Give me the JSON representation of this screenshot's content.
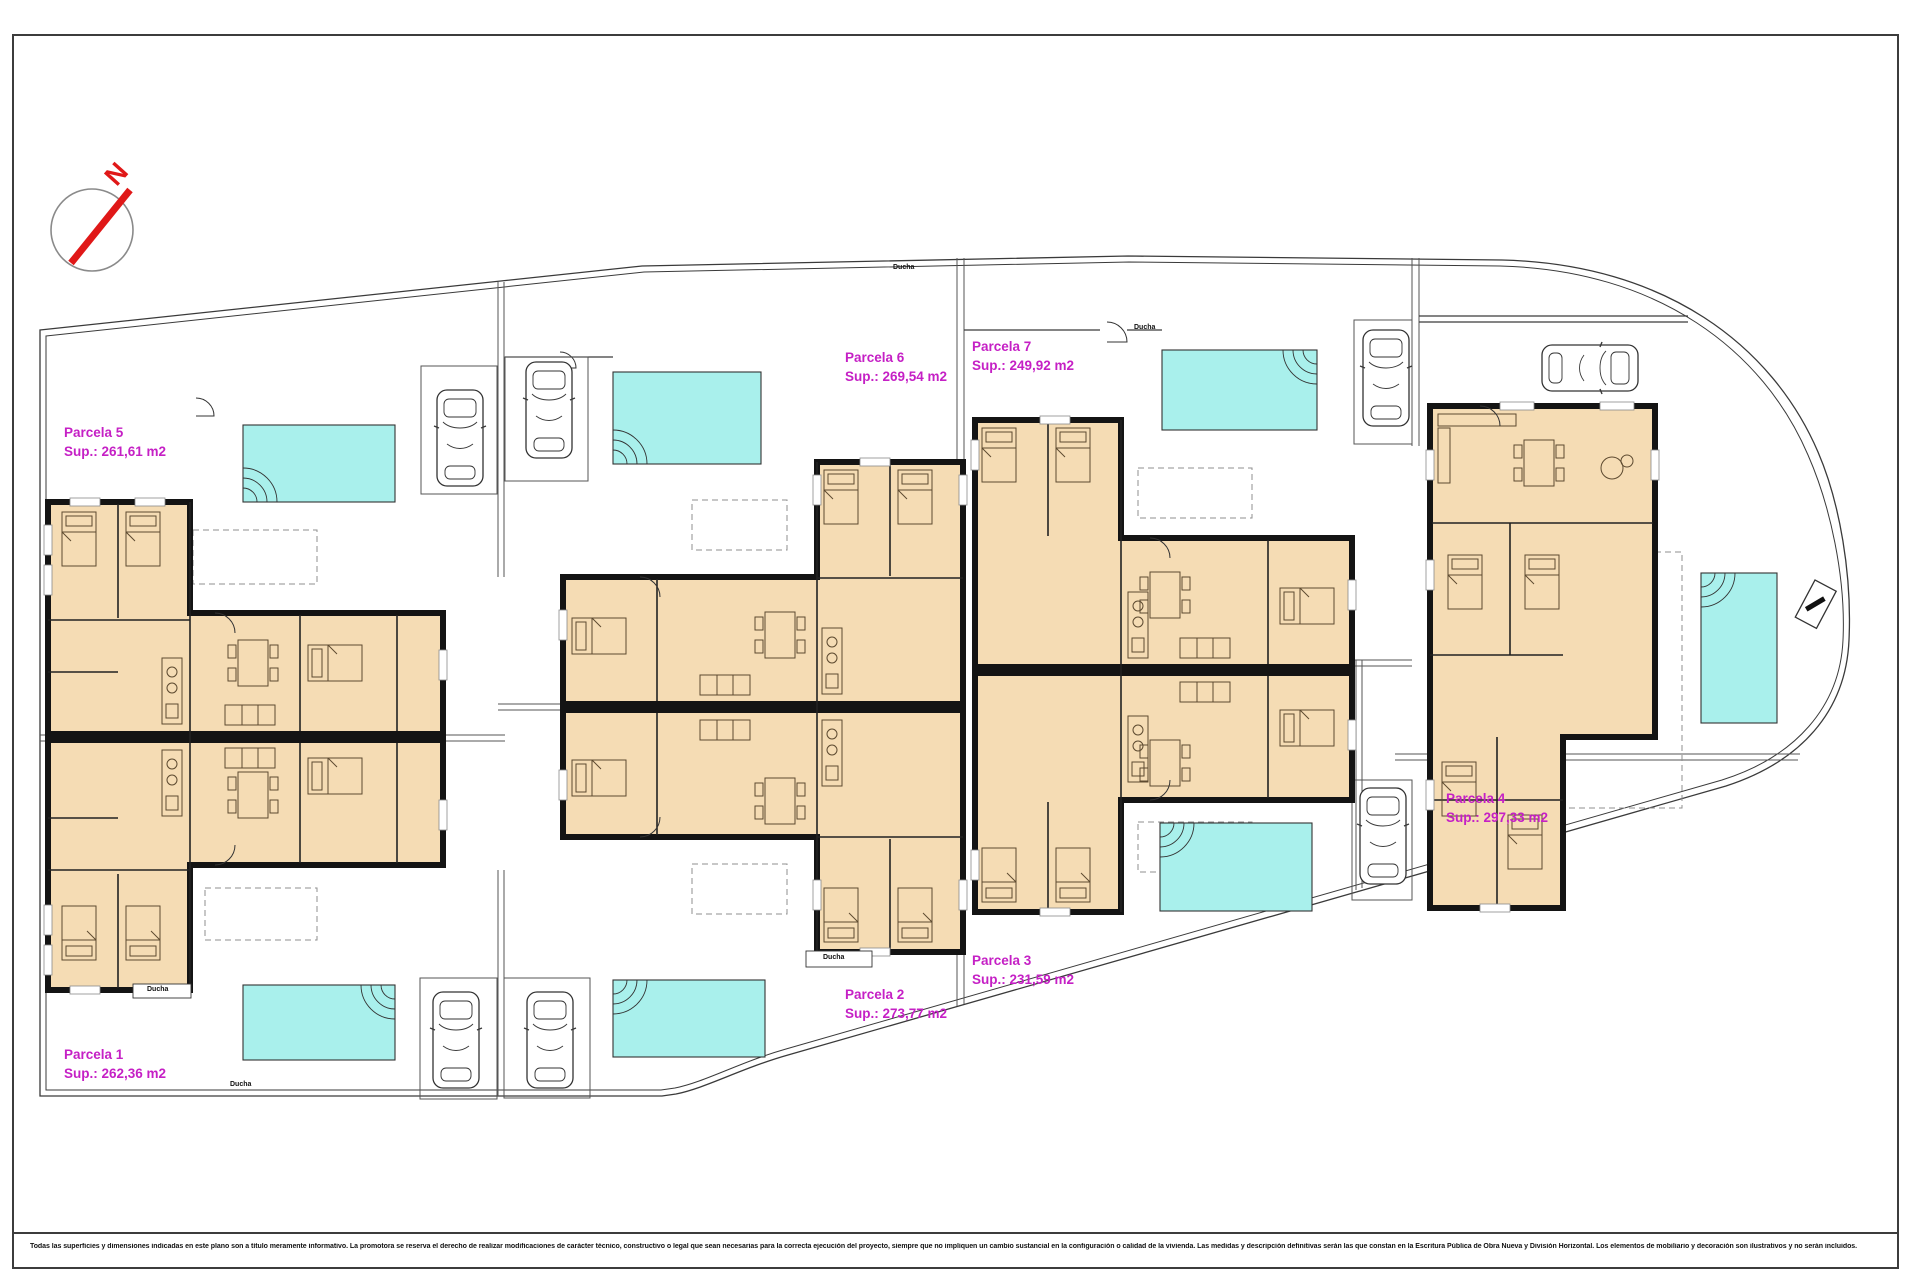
{
  "compass": {
    "north_label": "N"
  },
  "parcels": [
    {
      "name": "Parcela 1",
      "area": "Sup.: 262,36 m2"
    },
    {
      "name": "Parcela 2",
      "area": "Sup.: 273,77 m2"
    },
    {
      "name": "Parcela 3",
      "area": "Sup.: 231,59 m2"
    },
    {
      "name": "Parcela 4",
      "area": "Sup.: 297,33 m2"
    },
    {
      "name": "Parcela 5",
      "area": "Sup.: 261,61 m2"
    },
    {
      "name": "Parcela 6",
      "area": "Sup.: 269,54 m2"
    },
    {
      "name": "Parcela 7",
      "area": "Sup.: 249,92 m2"
    }
  ],
  "annotations": {
    "outdoor_shower": "Ducha"
  },
  "footer": {
    "disclaimer": "Todas las superficies y dimensiones indicadas en este plano son a título meramente informativo. La promotora se reserva el derecho de realizar modificaciones de carácter técnico, constructivo o legal que sean necesarias para la correcta ejecución del proyecto, siempre que no impliquen un cambio sustancial en la configuración o calidad de la vivienda. Las medidas y descripción definitivas serán las que constan en la Escritura Pública de Obra Nueva y División Horizontal. Los elementos de mobiliario y decoración son ilustrativos y no serán incluidos."
  },
  "colors": {
    "pool": "#a9f0ec",
    "building_fill": "#f5dcb4",
    "wall": "#141414",
    "parcel_label": "#c520c5",
    "north_arrow": "#e01818"
  }
}
